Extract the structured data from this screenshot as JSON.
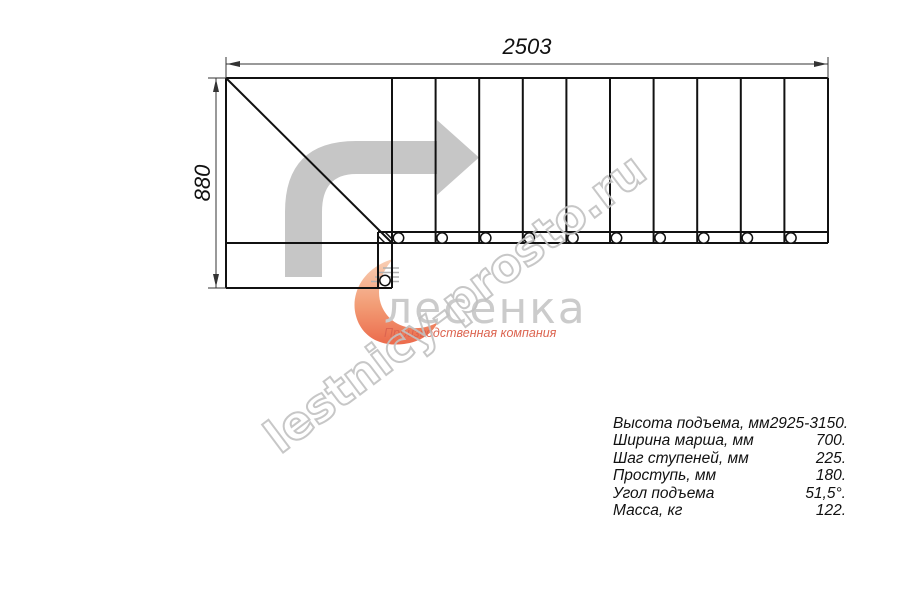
{
  "drawing": {
    "dim_width_label": "2503",
    "dim_height_label": "880",
    "line_color": "#111111",
    "direction_arrow_color": "#c6c6c6"
  },
  "watermark": {
    "text": "lestnicy-prosto.ru",
    "color": "#c2c2c2"
  },
  "logo": {
    "name": "лесенка",
    "tagline": "Производственная компания",
    "name_color": "#cbcbcb",
    "tagline_color": "#dc6450",
    "mark_colors": [
      "#f8c7a8",
      "#f08a5c",
      "#e8502c"
    ]
  },
  "specs": {
    "rows": [
      {
        "label": "Высота подъема, мм",
        "value": "2925-3150."
      },
      {
        "label": "Ширина марша, мм",
        "value": "700."
      },
      {
        "label": "Шаг ступеней, мм",
        "value": "225."
      },
      {
        "label": "Проступь, мм",
        "value": "180."
      },
      {
        "label": "Угол подъема",
        "value": "51,5°."
      },
      {
        "label": "Масса, кг",
        "value": "122."
      }
    ]
  }
}
